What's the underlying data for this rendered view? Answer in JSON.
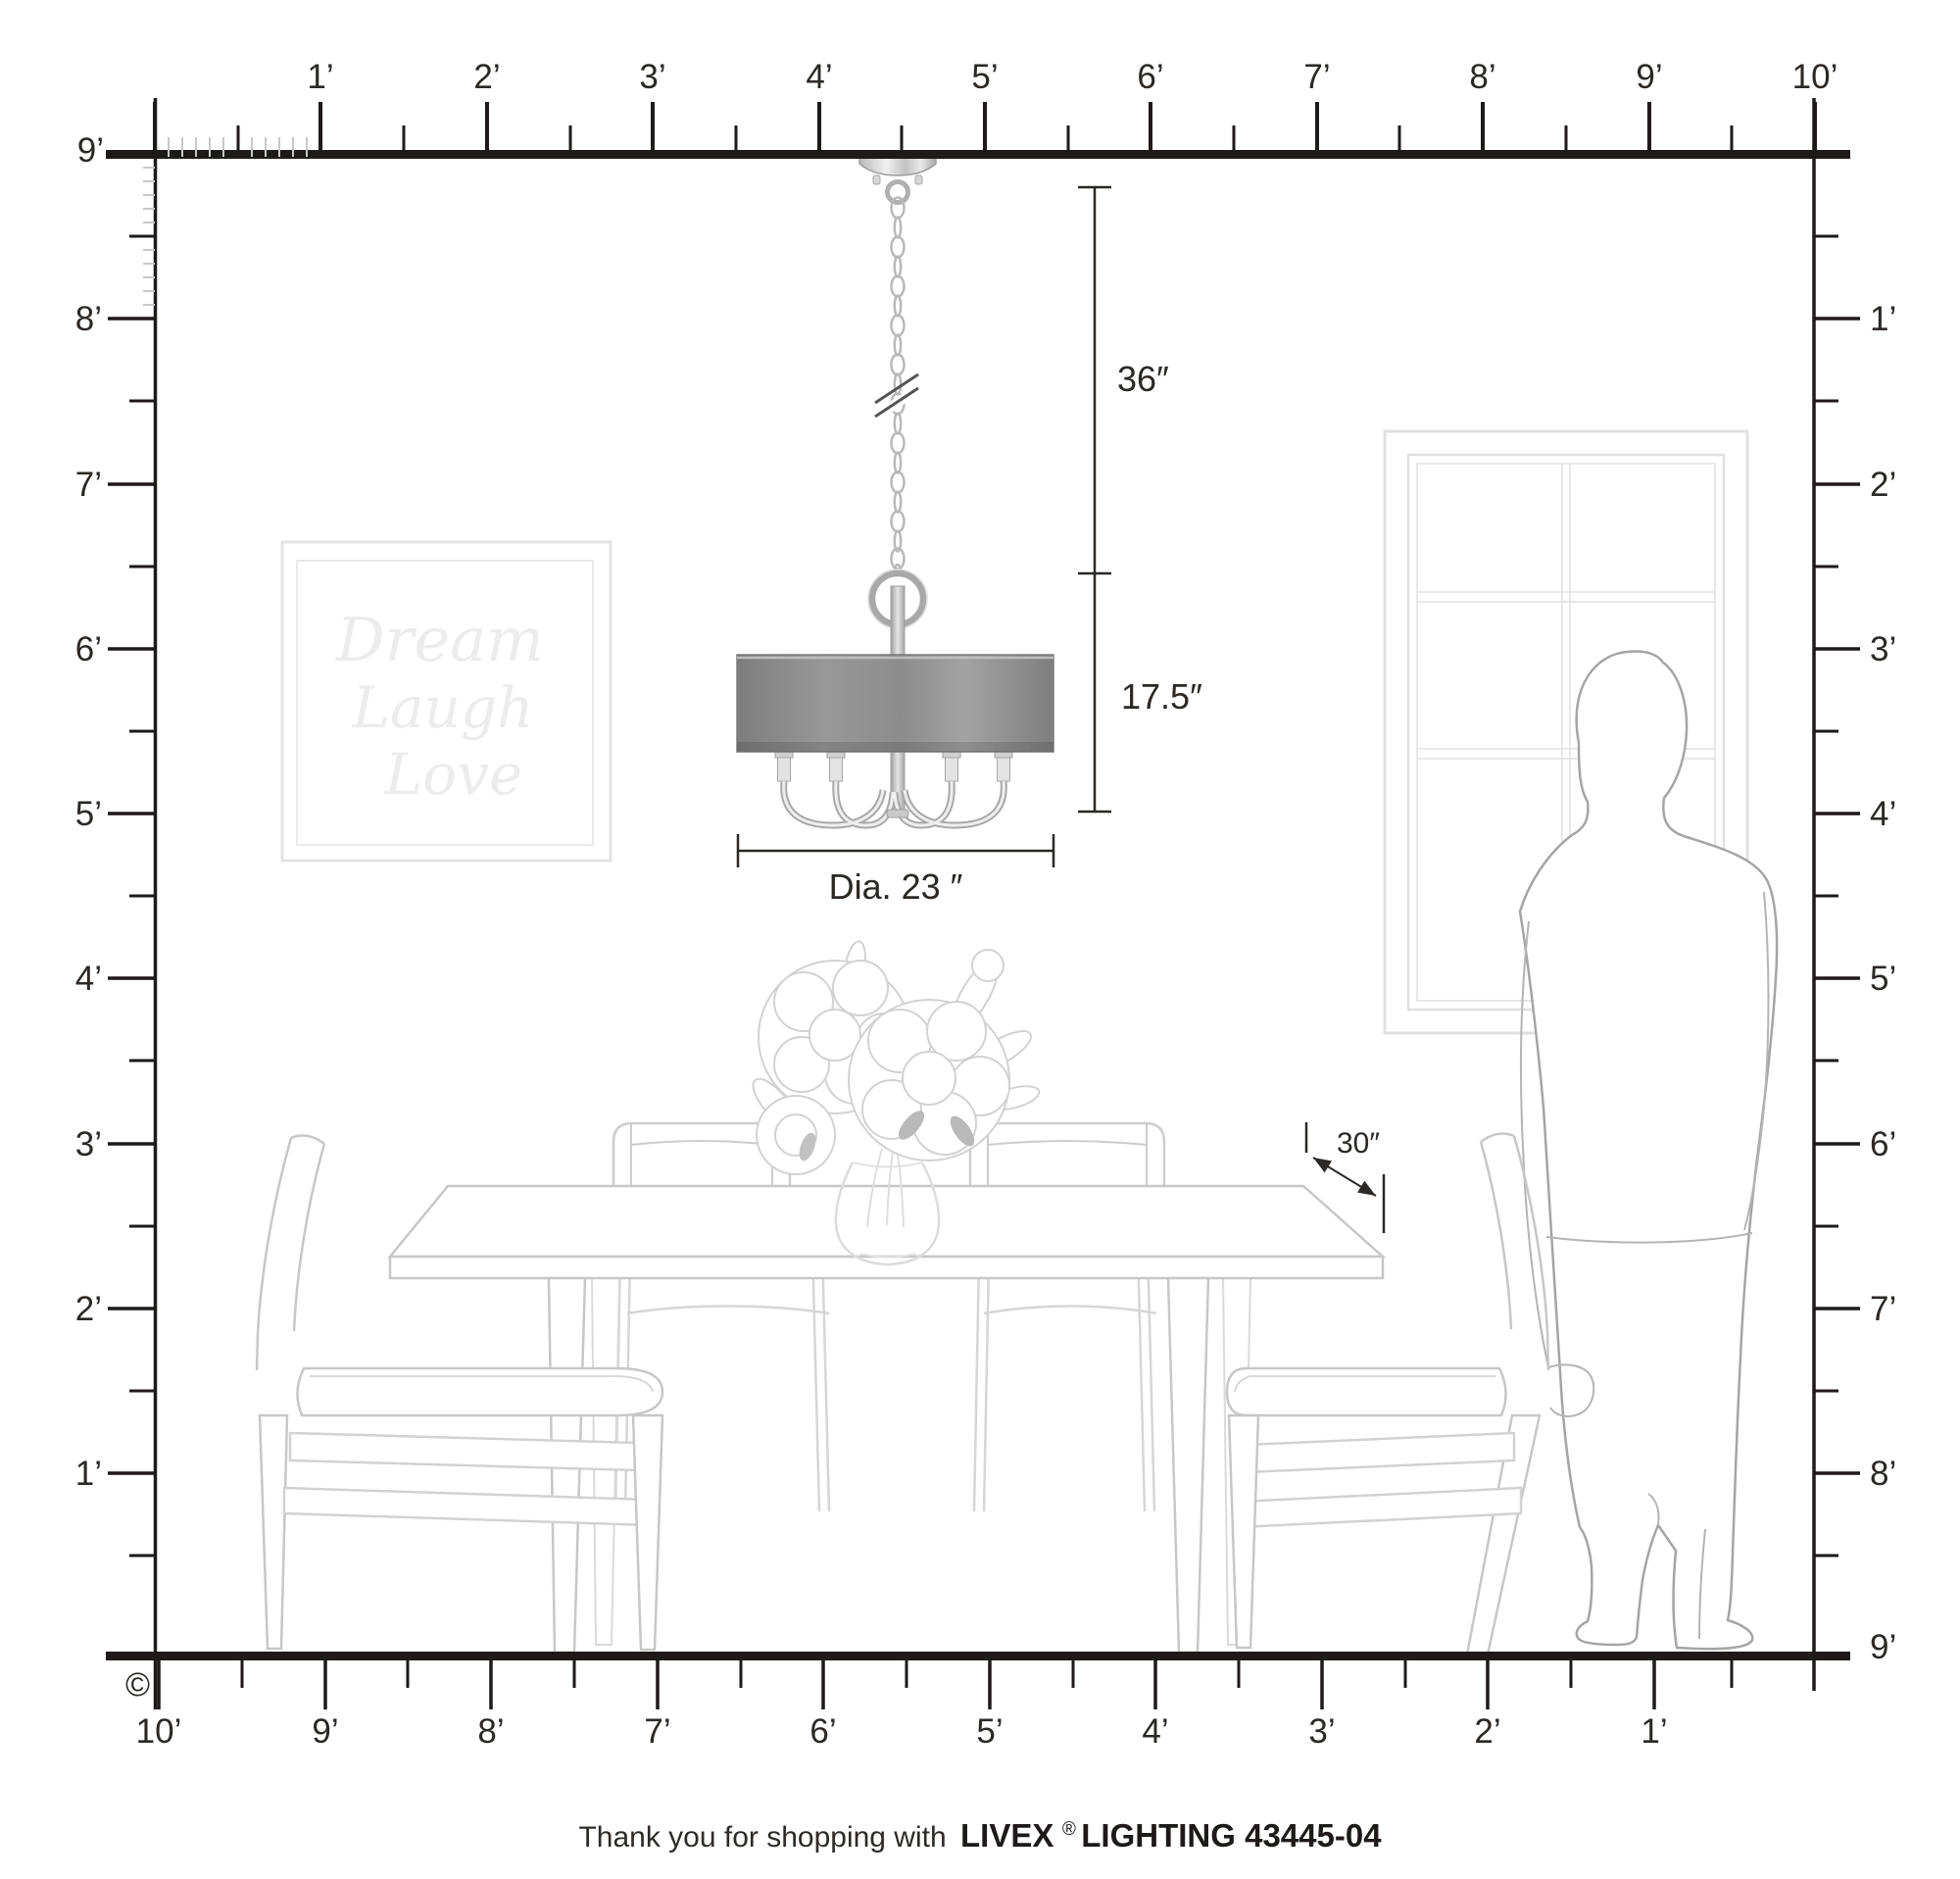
{
  "product": {
    "footer_prefix": "Thank you for shopping with ",
    "brand": "LIVEX",
    "registered_mark": "®",
    "brand_suffix": "LIGHTING 43445-04",
    "copyright_symbol": "©"
  },
  "fixture_dimensions": {
    "hang_height": "36″",
    "body_height": "17.5″",
    "diameter": "Dia. 23 ″",
    "table_clearance": "30″"
  },
  "wall_art": {
    "line1": "Dream",
    "line2": "Laugh",
    "line3": "Love"
  },
  "rulers": {
    "unit": "feet",
    "top": {
      "labels": [
        "1’",
        "2’",
        "3’",
        "4’",
        "5’",
        "6’",
        "7’",
        "8’",
        "9’",
        "10’"
      ]
    },
    "left": {
      "labels": [
        "9’",
        "8’",
        "7’",
        "6’",
        "5’",
        "4’",
        "3’",
        "2’",
        "1’"
      ]
    },
    "right": {
      "labels": [
        "1’",
        "2’",
        "3’",
        "4’",
        "5’",
        "6’",
        "7’",
        "8’",
        "9’"
      ]
    },
    "bottom": {
      "labels": [
        "10’",
        "9’",
        "8’",
        "7’",
        "6’",
        "5’",
        "4’",
        "3’",
        "2’",
        "1’"
      ]
    }
  },
  "colors": {
    "ink": "#2b2826",
    "wall_line": "#1d1a19",
    "furniture_line": "#c7c7c7",
    "furniture_light": "#d9d9d9",
    "person_line": "#a5a5a5",
    "art_line": "#e3e3e3",
    "window_line": "#e0e0e0",
    "shade_gray": "#8f8f8f",
    "metal_gray": "#a8a8a8"
  }
}
